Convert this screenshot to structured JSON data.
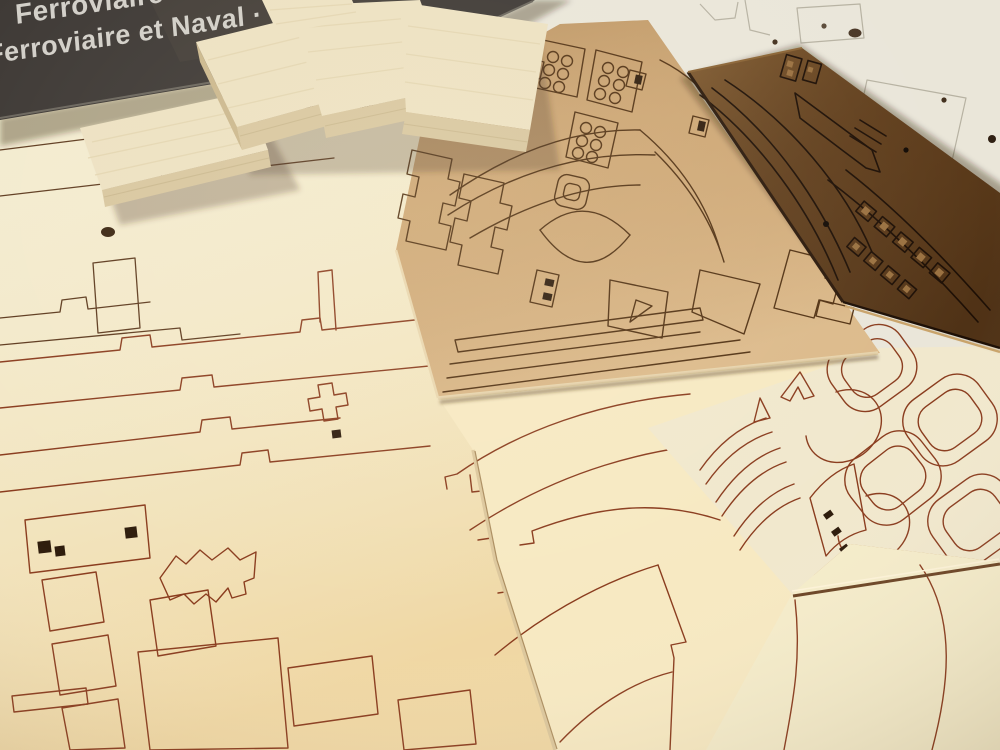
{
  "box": {
    "label_line1": "Ferroviaire",
    "label_line2": "Ferroviaire et Naval · Mo"
  },
  "materials": {
    "balsa_block_count": 5,
    "laser_sheet_count": 7
  },
  "colors": {
    "background": "#c59a66",
    "box": "#3c3733",
    "box_text": "#d2cfc8",
    "sheet_white": "#eae6d9",
    "sheet_left": "#f3ebcf",
    "sheet_bottom": "#f7e9c2",
    "sheet_frames": "#f1e8cd",
    "sheet_bottom_right": "#f5ecca",
    "sheet_center": "#cda673",
    "sheet_walnut": "#6d4823",
    "balsa_top": "#ede1c1",
    "balsa_side": "#d8c69e",
    "cut_line_red": "#8a3c1e",
    "cut_line_center": "#523213",
    "cut_line_walnut": "#1d0f05"
  }
}
